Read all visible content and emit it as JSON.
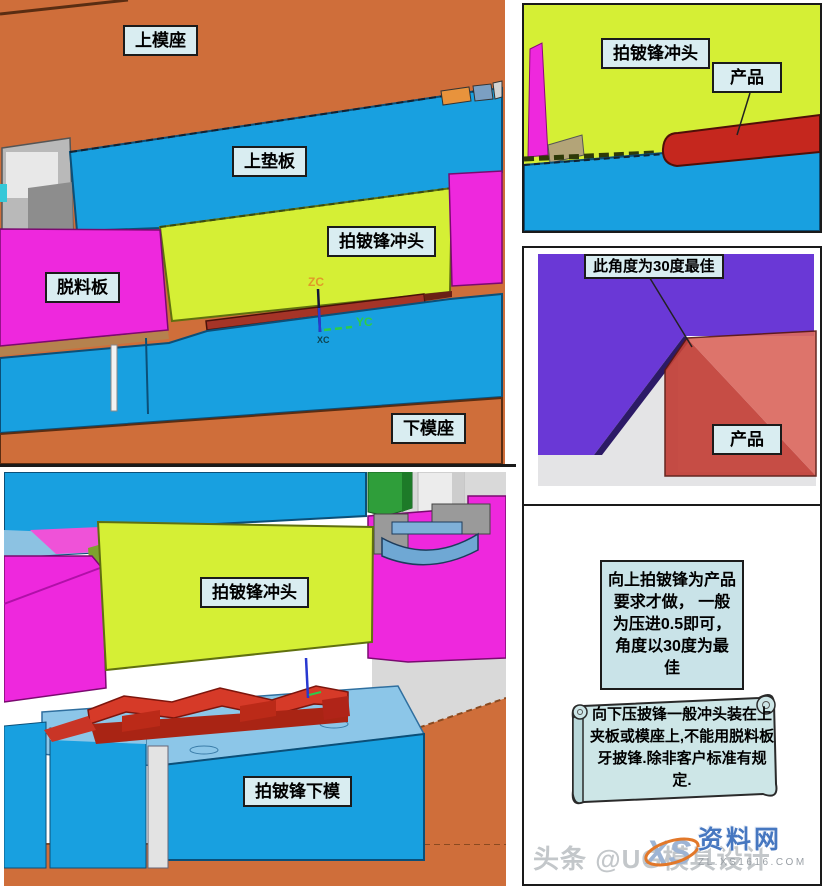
{
  "meta": {
    "watermark": "头条 @UG模具设计"
  },
  "logo": {
    "monogram": "XS",
    "name": "资料网",
    "domain": "ZL.XS1616.COM"
  },
  "panels": {
    "top_left": {
      "labels": {
        "upper_die_base": "上模座",
        "upper_backing_plate": "上垫板",
        "burr_punch": "拍铍锋冲头",
        "stripper_plate": "脱料板",
        "lower_die_base": "下模座"
      },
      "axis": {
        "zc": "ZC",
        "yc": "YC",
        "xc": "XC"
      }
    },
    "top_right": {
      "labels": {
        "burr_punch": "拍铍锋冲头",
        "product": "产品"
      }
    },
    "middle_right": {
      "labels": {
        "angle_note": "此角度为30度最佳",
        "product": "产品"
      }
    },
    "bottom_left": {
      "labels": {
        "burr_punch": "拍铍锋冲头",
        "burr_lower_die": "拍铍锋下模"
      }
    },
    "bottom_right": {
      "note_upward": "向上拍铍锋为产品要求才做， 一般为压进0.5即可，角度以30度为最佳",
      "note_downward": "向下压披锋一般冲头装在上夹板或模座上,不能用脱料板牙披锋.除非客户标准有规定."
    }
  },
  "colors": {
    "die_base_orange": "#cf6e3a",
    "plate_blue": "#18a0e0",
    "punch_yellowgreen": "#d5ef35",
    "stripper_magenta": "#ee28dd",
    "product_red": "#c5271e",
    "block_purple": "#6a38d6",
    "label_fill": "#d9edf1",
    "note_fill": "#c9e3e8"
  }
}
